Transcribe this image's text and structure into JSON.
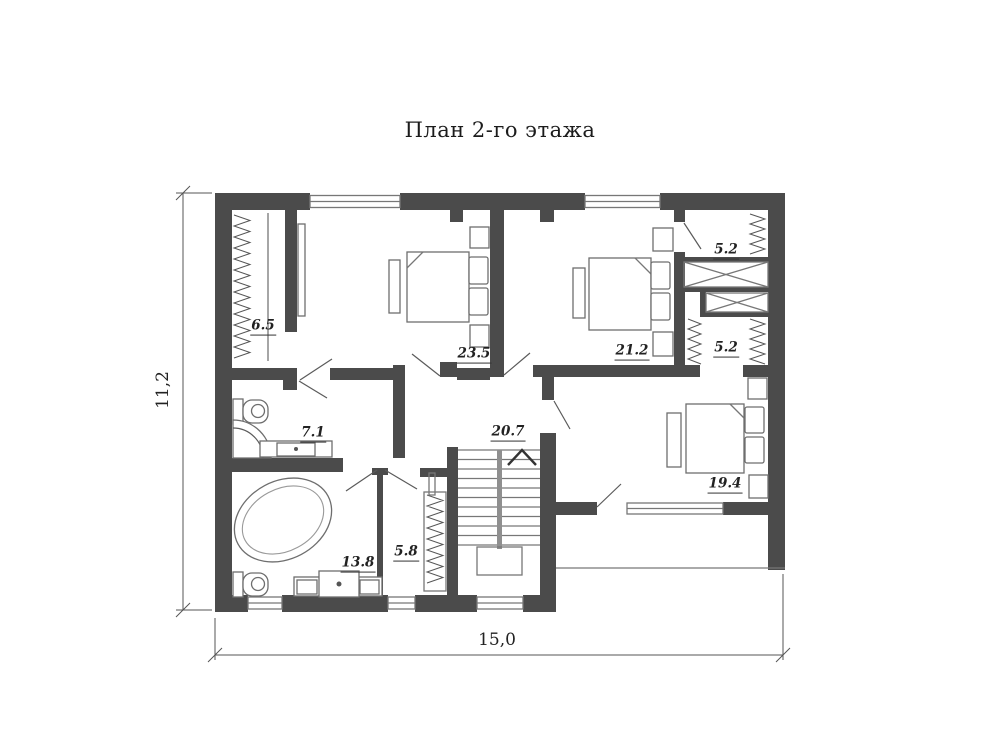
{
  "title": "План 2-го этажа",
  "dimensions": {
    "width": "15,0",
    "height": "11,2"
  },
  "room_labels": {
    "wardrobe": "6.5",
    "bedroom1": "23.5",
    "bedroom2": "21.2",
    "closet_upper": "5.2",
    "closet_lower": "5.2",
    "bathroom_small": "7.1",
    "hall": "20.7",
    "bedroom3": "19.4",
    "bathroom_large": "13.8",
    "corridor": "5.8"
  },
  "colors": {
    "wall": "#4b4b4b",
    "line": "#777777",
    "label": "#222222"
  }
}
